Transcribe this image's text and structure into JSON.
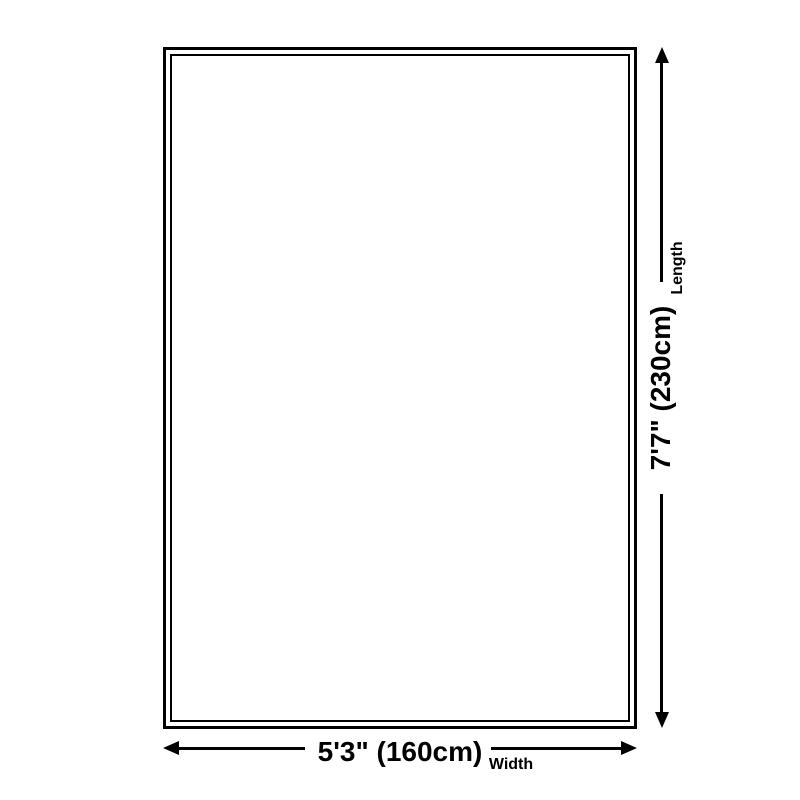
{
  "diagram": {
    "description_colors": {
      "line": "#000000",
      "text": "#000000",
      "background": "#ffffff"
    },
    "length_dimension": {
      "label": "Length",
      "value": "7'7\" (230cm)"
    },
    "width_dimension": {
      "label": "Width",
      "value": "5'3\" (160cm)"
    }
  }
}
